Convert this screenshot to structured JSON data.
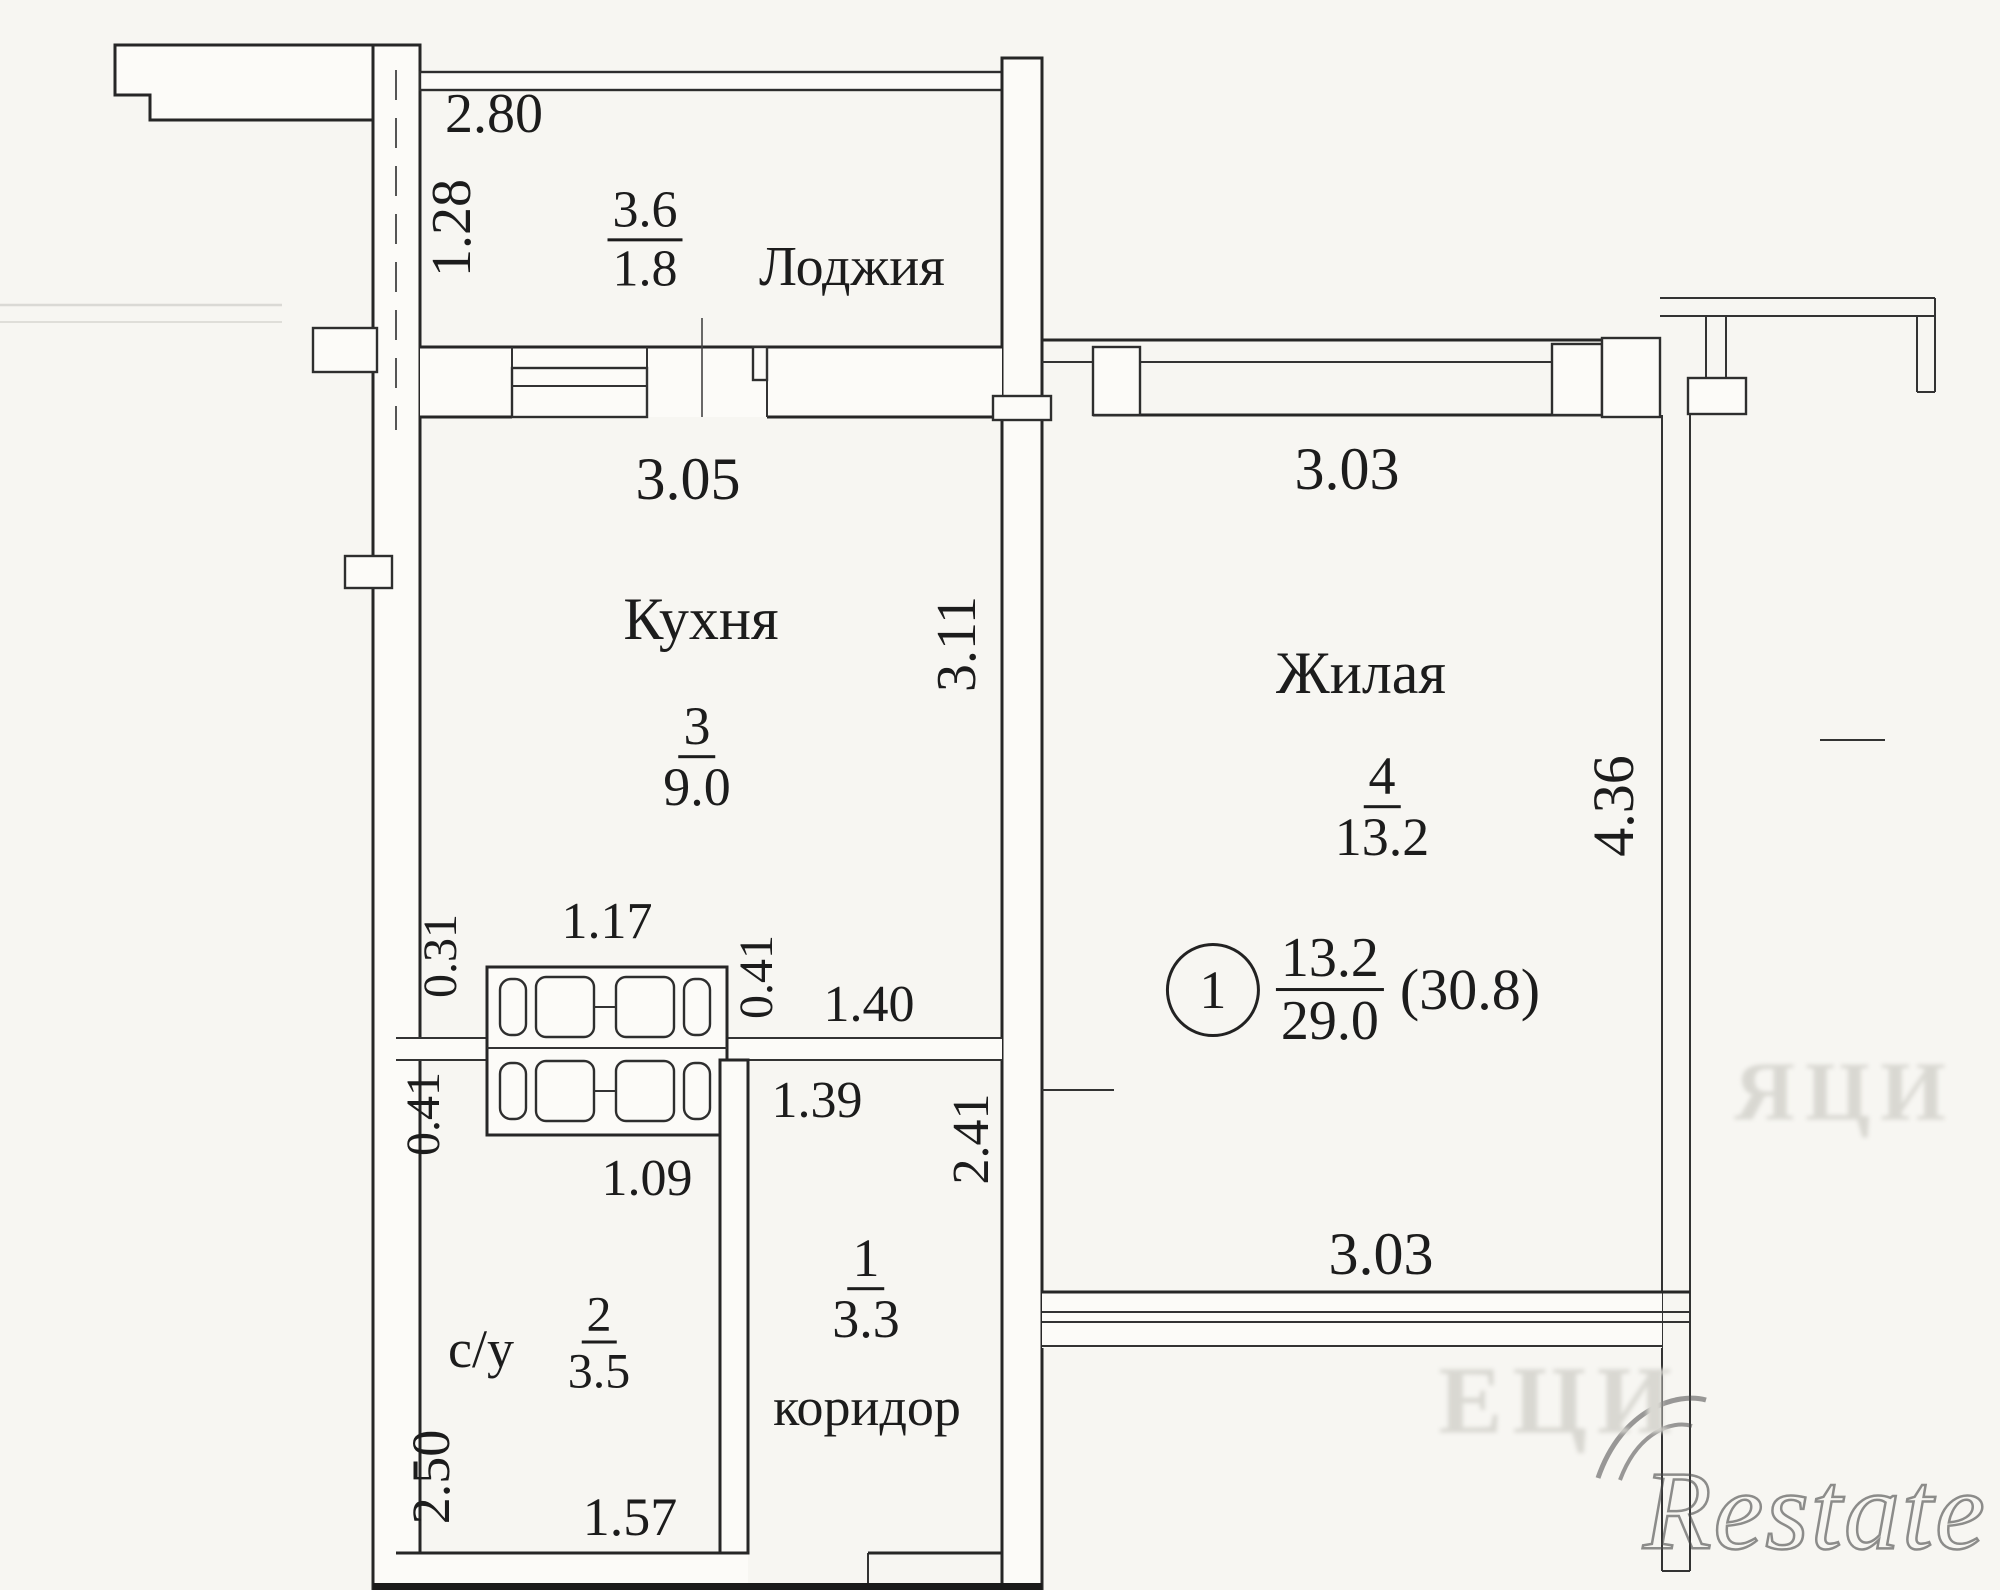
{
  "plan": {
    "rooms": {
      "loggia": {
        "label": "Лоджия",
        "area_over": "3.6",
        "area_under": "1.8"
      },
      "kitchen": {
        "label": "Кухня",
        "number": "3",
        "area": "9.0"
      },
      "living": {
        "label": "Жилая",
        "number": "4",
        "area": "13.2"
      },
      "bathroom": {
        "label": "с/у",
        "number": "2",
        "area": "3.5"
      },
      "corridor": {
        "label": "коридор",
        "number": "1",
        "area": "3.3"
      }
    },
    "summary": {
      "flat_number": "1",
      "living_area": "13.2",
      "total_area": "29.0",
      "overall": "(30.8)"
    },
    "dims": {
      "d280": "2.80",
      "d128": "1.28",
      "d305": "3.05",
      "d311": "3.11",
      "d303top": "3.03",
      "d303bottom": "3.03",
      "d436": "4.36",
      "d031": "0.31",
      "d117": "1.17",
      "d041r": "0.41",
      "d140": "1.40",
      "d041l": "0.41",
      "d109": "1.09",
      "d139": "1.39",
      "d241": "2.41",
      "d250": "2.50",
      "d157": "1.57"
    },
    "watermark": {
      "brand": "Restate",
      "faint_fragment_left": "ЕЦИ",
      "faint_fragment_right": "ЯЦИ"
    }
  }
}
